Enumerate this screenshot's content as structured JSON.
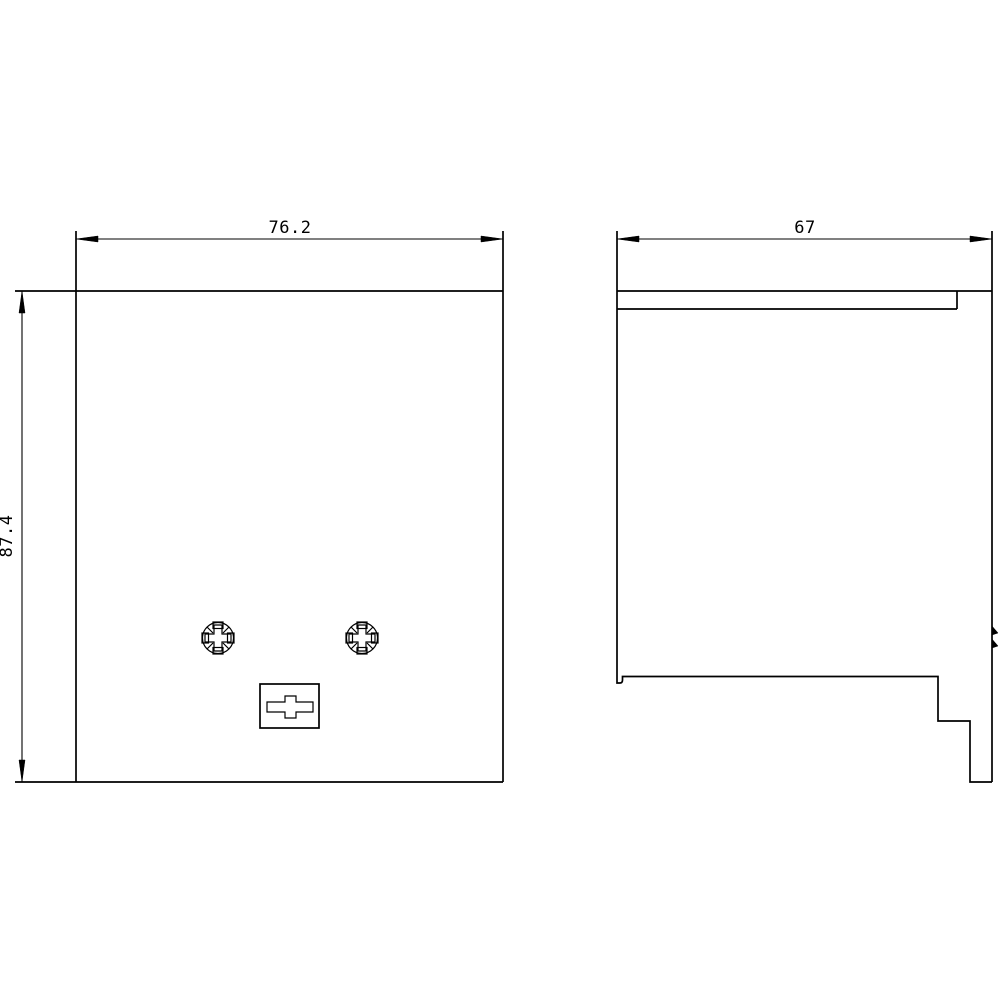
{
  "canvas": {
    "background": "#ffffff",
    "line_color": "#000000"
  },
  "drawing": {
    "kind": "technical-dimension-drawing",
    "front_view": {
      "width_label": "76.2",
      "height_label": "87.4",
      "features": [
        {
          "icon": "pozidriv-screw-icon",
          "position": "left"
        },
        {
          "icon": "pozidriv-screw-icon",
          "position": "right"
        },
        {
          "icon": "cross-slot-icon",
          "position": "bottom-center"
        }
      ]
    },
    "side_view": {
      "depth_label": "67",
      "features": [
        {
          "icon": "top-groove",
          "position": "top"
        },
        {
          "icon": "clip-hooks",
          "position": "right-edge"
        },
        {
          "icon": "stepped-foot",
          "position": "bottom-right"
        }
      ]
    }
  }
}
